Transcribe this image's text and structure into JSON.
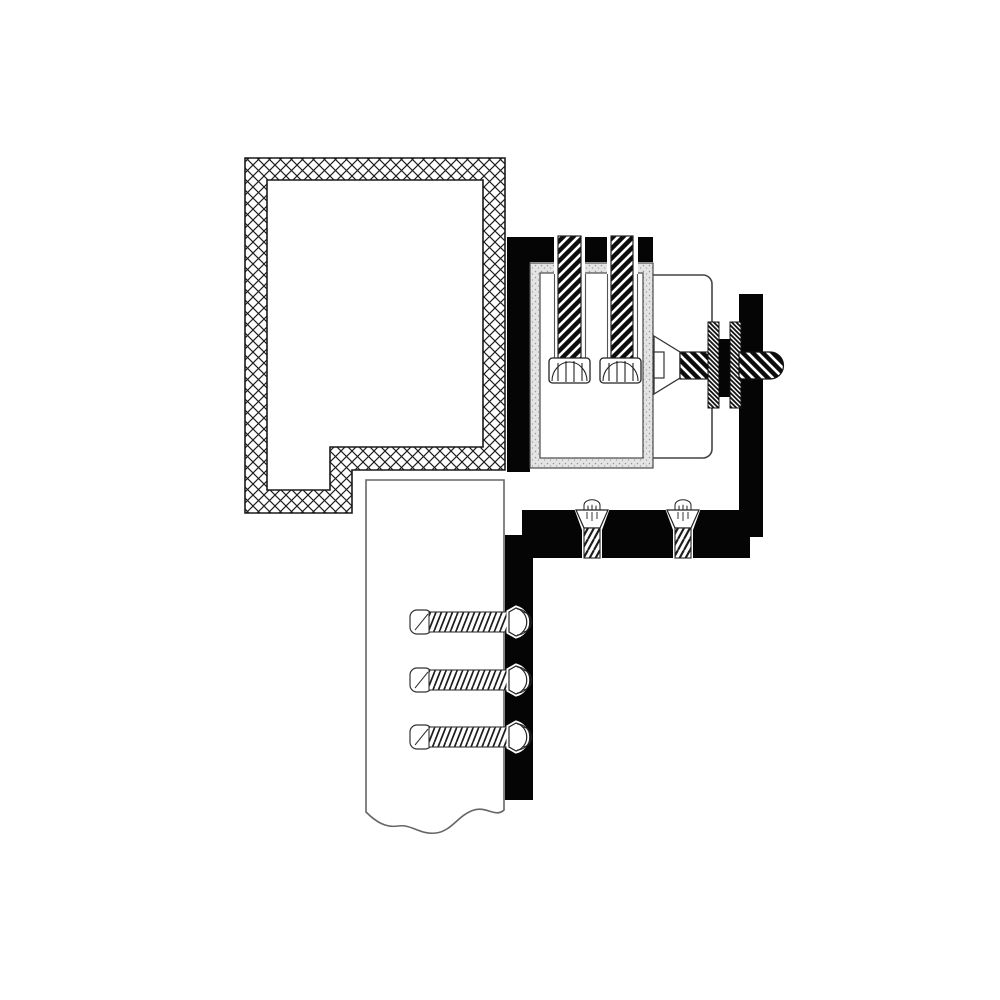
{
  "canvas": {
    "width": 1000,
    "height": 1000,
    "background": "#ffffff"
  },
  "palette": {
    "ink": "#050505",
    "outline_dark": "#222222",
    "outline_mid": "#3a3a3a",
    "outline_light": "#666666",
    "case_band_fill": "#e4e4e4",
    "speckle_dot": "#969696",
    "white": "#ffffff"
  },
  "diagram": {
    "kind": "technical cross-section installation diagram (no text labels)",
    "components": {
      "frame_profile": "cross-hatched frame profile, L-shaped tube section",
      "mounting_plate": "black L-shaped mounting plate",
      "lock_case": "lock case shell with stippled walls",
      "cap_screw_left": "left vertical cap screw with knurled head",
      "cap_screw_right": "right vertical cap screw with knurled head",
      "cylinder_housing": "rounded cylinder housing",
      "spindle": "countersunk spindle with hatched shank",
      "washer_inner": "inner hatched washer",
      "washer_outer": "outer hatched washer",
      "spacer": "black spacer block",
      "side_plate": "black side plate",
      "through_bolt": "horizontal through-bolt with domed end",
      "bottom_plate": "black bottom mounting plate",
      "flat_screw_left": "left countersunk flat-head screw",
      "flat_screw_right": "right countersunk flat-head screw",
      "door_panel": "door panel shown with wavy break line",
      "edge_strip": "black door edge strip",
      "wood_screw_top": "top horizontal wood screw",
      "wood_screw_middle": "middle horizontal wood screw",
      "wood_screw_bottom": "bottom horizontal wood screw"
    }
  }
}
